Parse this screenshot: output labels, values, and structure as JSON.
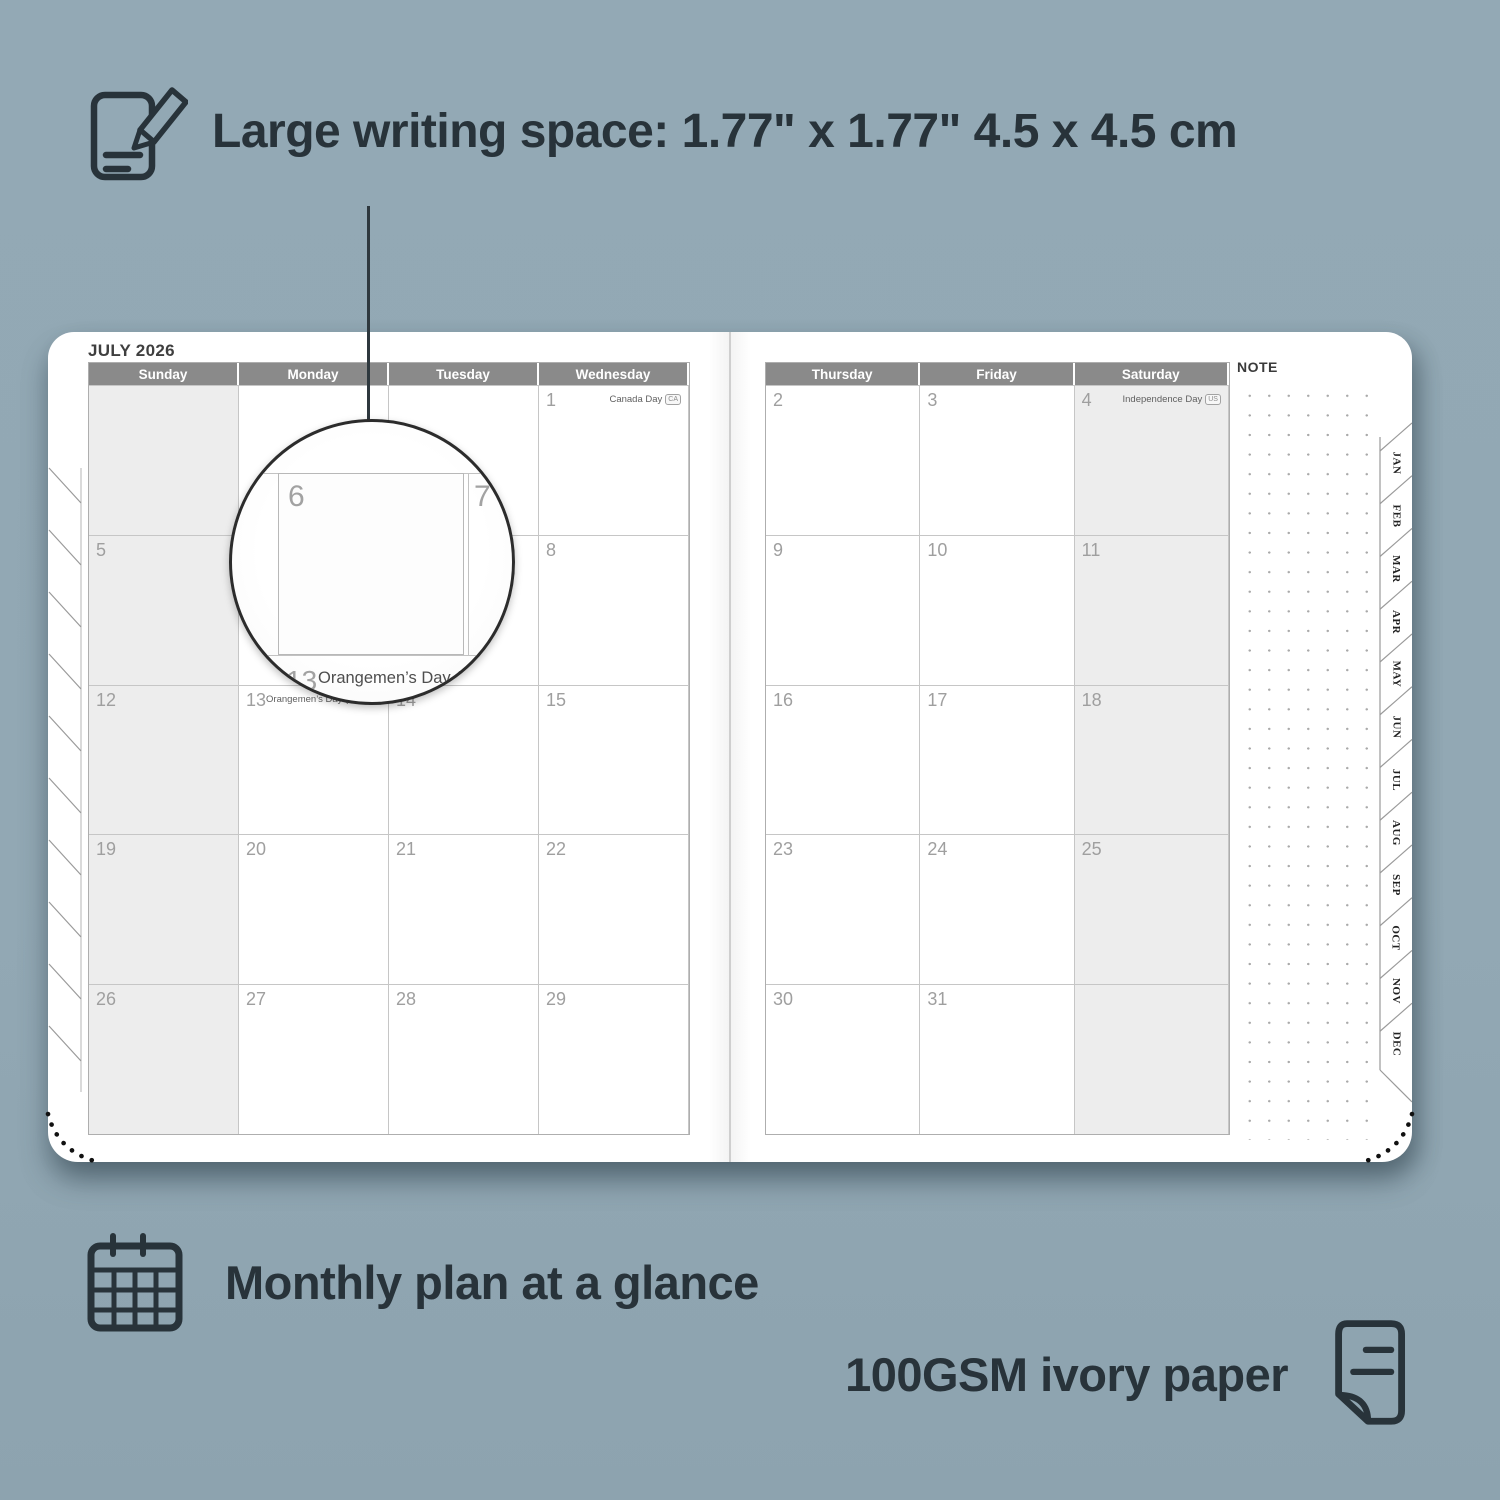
{
  "colors": {
    "background": "#92a8b4",
    "ink_dark": "#28333a",
    "header_gray": "#8a8a8a",
    "weekend_shade": "#ededed"
  },
  "callout": {
    "label": "Large writing space: 1.77\" x 1.77\" 4.5 x 4.5 cm"
  },
  "captions": {
    "monthly_label": "Monthly plan at a glance",
    "paper_label": "100GSM ivory paper"
  },
  "planner": {
    "month_title": "JULY 2026",
    "note_label": "NOTE",
    "left_page": {
      "headers": [
        "Sunday",
        "Monday",
        "Tuesday",
        "Wednesday"
      ],
      "rows": [
        [
          {
            "day": ""
          },
          {
            "day": ""
          },
          {
            "day": ""
          },
          {
            "day": "1",
            "holiday": "Canada Day",
            "badge": "CA"
          }
        ],
        [
          {
            "day": "5"
          },
          {
            "day": "6"
          },
          {
            "day": "7"
          },
          {
            "day": "8"
          }
        ],
        [
          {
            "day": "12"
          },
          {
            "day": "13",
            "holiday": "Orangemen’s Day (n.i.)",
            "badge": "UK"
          },
          {
            "day": "14"
          },
          {
            "day": "15"
          }
        ],
        [
          {
            "day": "19"
          },
          {
            "day": "20"
          },
          {
            "day": "21"
          },
          {
            "day": "22"
          }
        ],
        [
          {
            "day": "26"
          },
          {
            "day": "27"
          },
          {
            "day": "28"
          },
          {
            "day": "29"
          }
        ]
      ]
    },
    "right_page": {
      "headers": [
        "Thursday",
        "Friday",
        "Saturday"
      ],
      "rows": [
        [
          {
            "day": "2"
          },
          {
            "day": "3"
          },
          {
            "day": "4",
            "holiday": "Independence Day",
            "badge": "US"
          }
        ],
        [
          {
            "day": "9"
          },
          {
            "day": "10"
          },
          {
            "day": "11"
          }
        ],
        [
          {
            "day": "16"
          },
          {
            "day": "17"
          },
          {
            "day": "18"
          }
        ],
        [
          {
            "day": "23"
          },
          {
            "day": "24"
          },
          {
            "day": "25"
          }
        ],
        [
          {
            "day": "30"
          },
          {
            "day": "31"
          },
          {
            "day": ""
          }
        ]
      ]
    },
    "month_tabs": [
      "JAN",
      "FEB",
      "MAR",
      "APR",
      "MAY",
      "JUN",
      "JUL",
      "AUG",
      "SEP",
      "OCT",
      "NOV",
      "DEC"
    ]
  },
  "magnifier": {
    "day": "6",
    "adjacent_day": "7",
    "next_week_day": "13",
    "holiday": "Orangemen’s Day (n.i.)",
    "badge": "UK"
  }
}
